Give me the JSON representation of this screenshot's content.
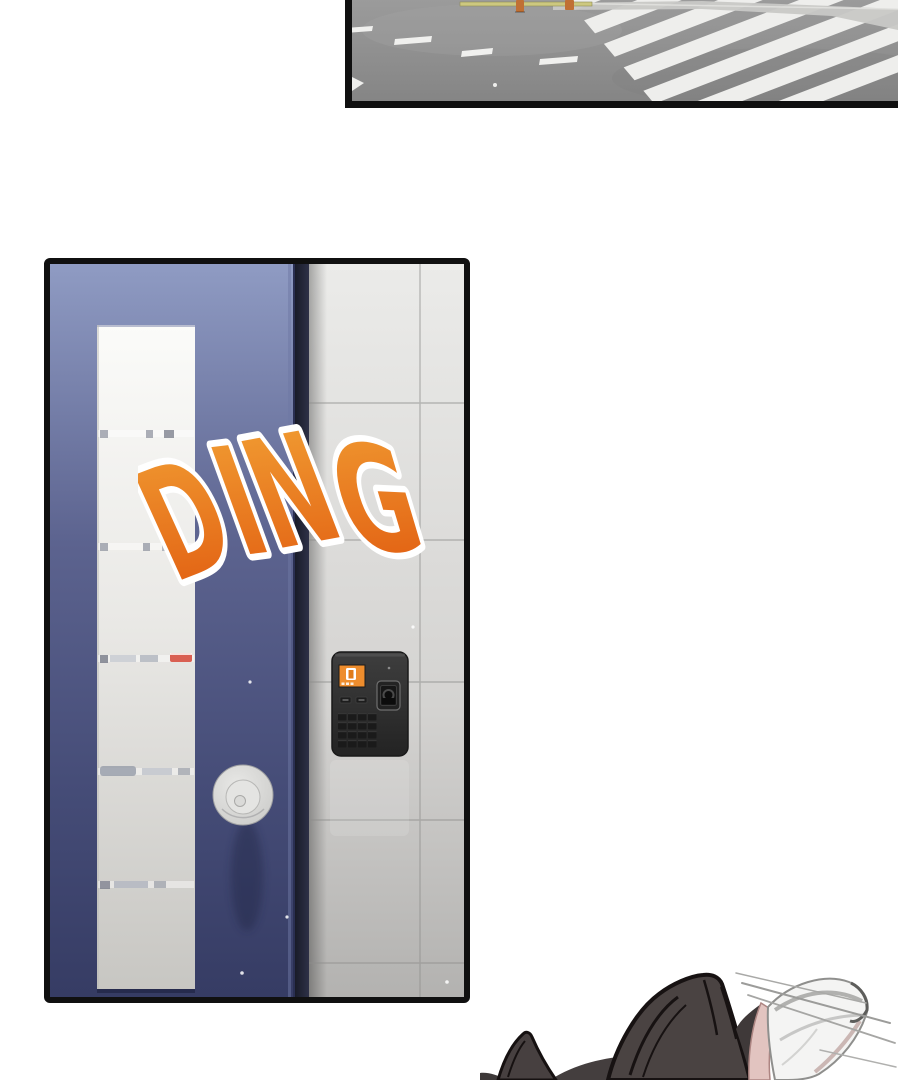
{
  "sfx": {
    "text": "DING",
    "letters": [
      "D",
      "I",
      "N",
      "G"
    ]
  },
  "palette": {
    "page_bg": "#ffffff",
    "panel_border": "#101010",
    "asphalt_top": "#9b9b9b",
    "asphalt_bottom": "#858585",
    "crosswalk_stripe": "#eeeeec",
    "lane_dash": "#f0f0ee",
    "guardrail_band": "#c8c8c6",
    "fence_bar": "#cdc87f",
    "fence_post": "#c07034",
    "door_blue_top": "#8f9bc3",
    "door_blue_mid": "#5c638f",
    "door_blue_bottom": "#363c64",
    "glass_top": "#fbfbf9",
    "glass_bottom": "#c7c6c2",
    "red_item": "#d95f52",
    "knob_gray": "#e8e8e6",
    "wall_top": "#ebebe9",
    "wall_bottom": "#b3b2b0",
    "keypad_body_top": "#3e3e3e",
    "keypad_body_bottom": "#232323",
    "keypad_screen_orange": "#ee8d2d",
    "sfx_orange_top": "#f2a135",
    "sfx_orange_bottom": "#e0580e",
    "sfx_outline": "#ffffff",
    "hair_dark": "#4a4342",
    "ear_inner_pink": "#e2c4c0",
    "white_ear": "#f4f4f3"
  }
}
